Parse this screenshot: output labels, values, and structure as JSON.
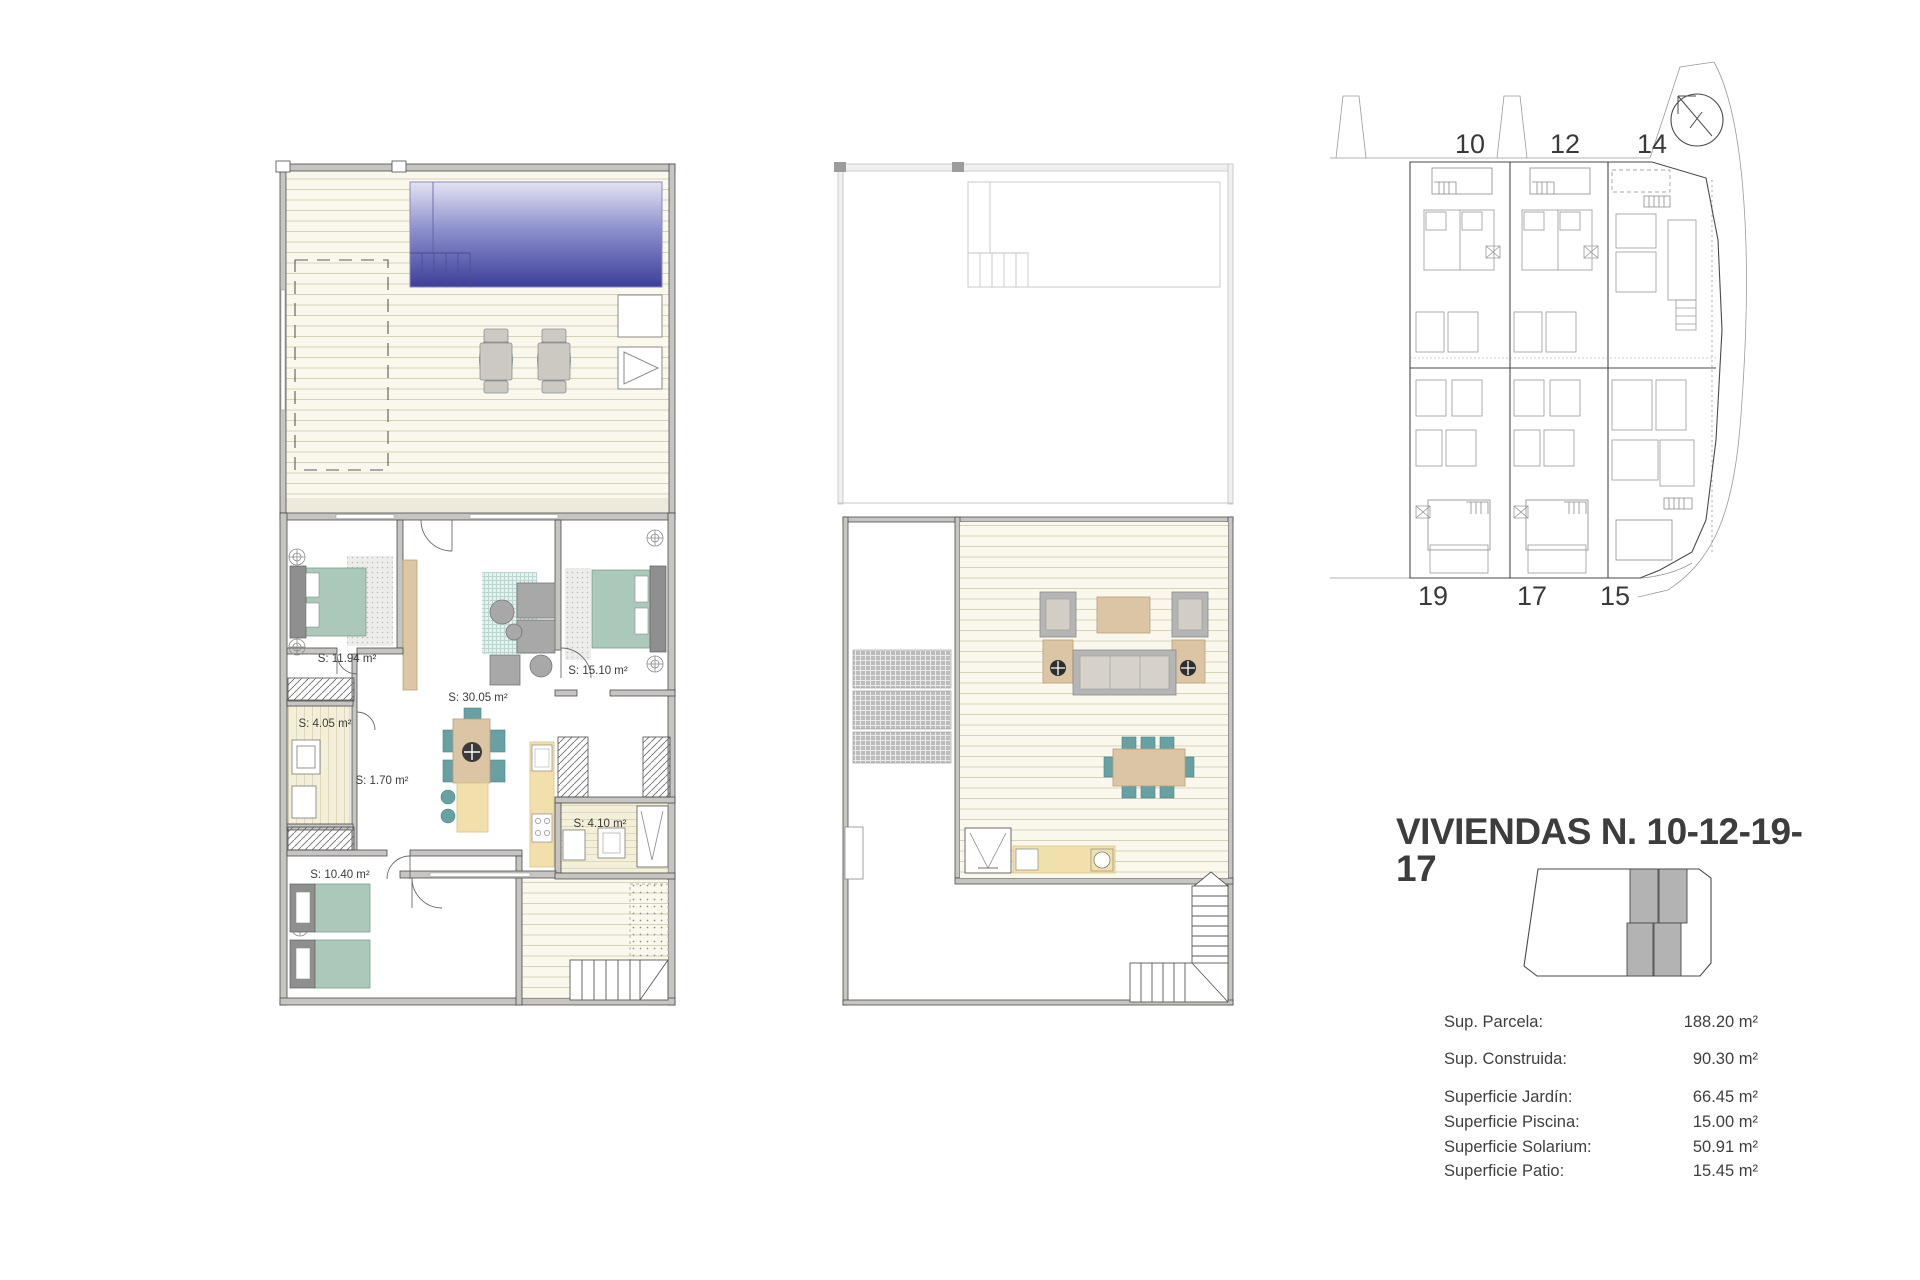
{
  "document": {
    "title": "VIVIENDAS N. 10-12-19-17"
  },
  "ground_floor_plan": {
    "rooms": [
      {
        "name": "bedroom-1",
        "label": "S: 11.94 m²"
      },
      {
        "name": "bathroom-1",
        "label": "S: 4.05 m²"
      },
      {
        "name": "hall",
        "label": "S: 1.70 m²"
      },
      {
        "name": "bedroom-3",
        "label": "S: 10.40 m²"
      },
      {
        "name": "living-kitchen",
        "label": "S: 30.05 m²"
      },
      {
        "name": "bedroom-2",
        "label": "S: 15.10 m²"
      },
      {
        "name": "bathroom-2",
        "label": "S: 4.10 m²"
      }
    ]
  },
  "site_plan": {
    "top_units": [
      "10",
      "12",
      "14"
    ],
    "bottom_units": [
      "19",
      "17",
      "15"
    ]
  },
  "surface_table": {
    "rows": [
      {
        "label": "Sup. Parcela:",
        "value": "188.20 m²"
      },
      {
        "label": "Sup. Construida:",
        "value": "90.30 m²"
      },
      {
        "label": "Superficie Jardín:",
        "value": "66.45 m²"
      },
      {
        "label": "Superficie Piscina:",
        "value": "15.00 m²"
      },
      {
        "label": "Superficie Solarium:",
        "value": "50.91 m²"
      },
      {
        "label": "Superficie Patio:",
        "value": "15.45 m²"
      }
    ]
  },
  "colors": {
    "pool_top": "#dcdcf0",
    "pool_bottom": "#3c3f9a",
    "deck": "#faf8ed",
    "deck_line": "#d6d2b6",
    "wall": "#c6c5c1",
    "bed_teal": "#abc9ba",
    "chair_teal": "#67a1a3",
    "wood_tan": "#dbc5a4",
    "counter_yellow": "#f2e0ac",
    "pergola_gray": "#bcbcbc"
  }
}
